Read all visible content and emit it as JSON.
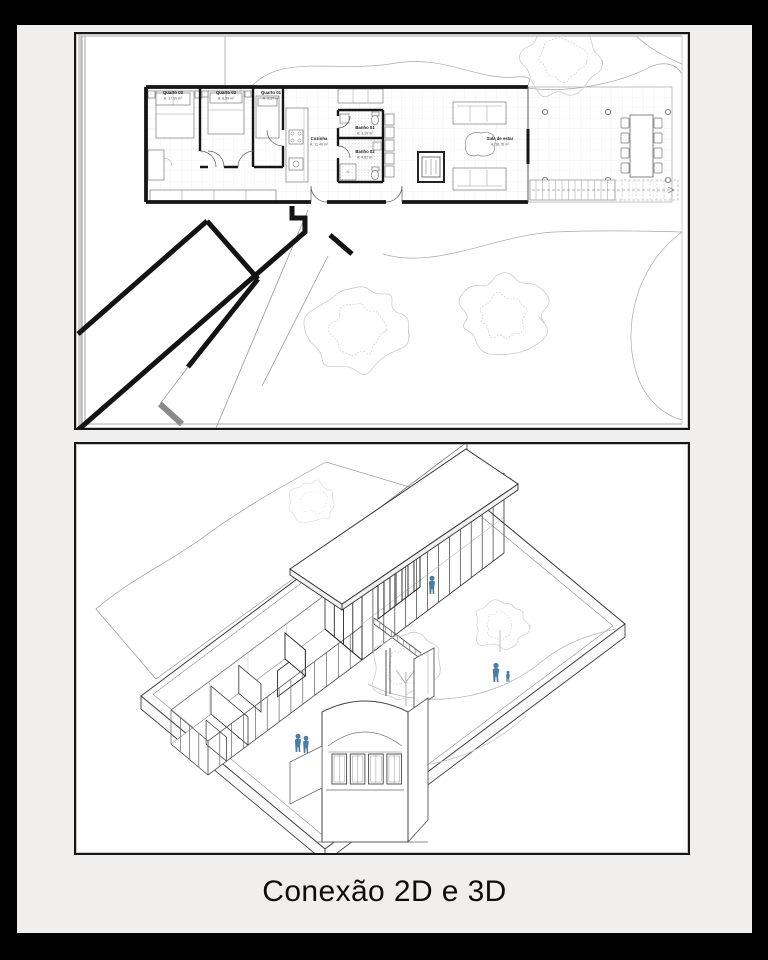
{
  "caption": "Conexão 2D e 3D",
  "plan": {
    "rooms": [
      {
        "name": "Quarto 03",
        "area": "A: 17,50 m²"
      },
      {
        "name": "Quarto 02",
        "area": "A: 8,59 m²"
      },
      {
        "name": "Quarto 01",
        "area": "A: 9,17 m²"
      },
      {
        "name": "Cozinha",
        "area": "A: 11,40 m²"
      },
      {
        "name": "Banho 01",
        "area": "A: 3,10 m²"
      },
      {
        "name": "Banho 02",
        "area": "A: 4,62 m²"
      },
      {
        "name": "Sala de estar",
        "area": "A: 38,76 m²"
      }
    ]
  },
  "axon": {
    "figure_count": 5
  },
  "colors": {
    "frame": "#000000",
    "slide_bg": "#f0efee",
    "panel_bg": "#ffffff",
    "panel_border": "#161616",
    "wall": "#151515",
    "sketch": "#8a8a8a",
    "tree": "#c6c6c6",
    "figure_blue": "#4a7da6"
  }
}
